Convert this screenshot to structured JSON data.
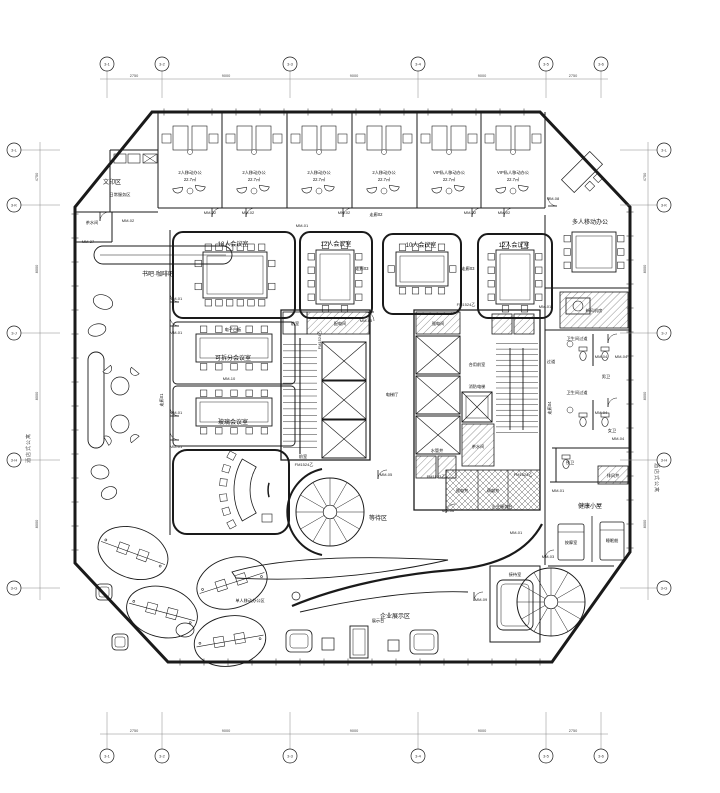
{
  "colors": {
    "line": "#1a1a1a",
    "grid": "#888888",
    "background": "#ffffff",
    "hatch": "#555555"
  },
  "plan": {
    "labels": [
      {
        "t": "文印区",
        "x": 112,
        "y": 184,
        "c": "r"
      },
      {
        "t": "日常服务区",
        "x": 120,
        "y": 196,
        "c": "s"
      },
      {
        "t": "茶水间",
        "x": 92,
        "y": 224,
        "c": "s"
      },
      {
        "t": "书吧·咖啡吧",
        "x": 158,
        "y": 276,
        "c": "r"
      },
      {
        "t": "2人移动办公",
        "x": 190,
        "y": 174,
        "c": "s"
      },
      {
        "t": "22.7㎡",
        "x": 190,
        "y": 181,
        "c": "s"
      },
      {
        "t": "2人移动办公",
        "x": 254,
        "y": 174,
        "c": "s"
      },
      {
        "t": "22.7㎡",
        "x": 254,
        "y": 181,
        "c": "s"
      },
      {
        "t": "2人移动办公",
        "x": 319,
        "y": 174,
        "c": "s"
      },
      {
        "t": "22.7㎡",
        "x": 319,
        "y": 181,
        "c": "s"
      },
      {
        "t": "2人移动办公",
        "x": 384,
        "y": 174,
        "c": "s"
      },
      {
        "t": "22.7㎡",
        "x": 384,
        "y": 181,
        "c": "s"
      },
      {
        "t": "VIP私人移动办公",
        "x": 449,
        "y": 174,
        "c": "s"
      },
      {
        "t": "22.7㎡",
        "x": 449,
        "y": 181,
        "c": "s"
      },
      {
        "t": "VIP私人移动办公",
        "x": 513,
        "y": 174,
        "c": "s"
      },
      {
        "t": "22.7㎡",
        "x": 513,
        "y": 181,
        "c": "s"
      },
      {
        "t": "多人移动办公",
        "x": 590,
        "y": 224,
        "c": "r"
      },
      {
        "t": "18人会议室",
        "x": 233,
        "y": 246,
        "c": "r"
      },
      {
        "t": "12人会议室",
        "x": 336,
        "y": 246,
        "c": "r"
      },
      {
        "t": "10人会议室",
        "x": 421,
        "y": 247,
        "c": "r"
      },
      {
        "t": "12人会议室",
        "x": 514,
        "y": 247,
        "c": "r"
      },
      {
        "t": "走廊02",
        "x": 376,
        "y": 216,
        "c": "s"
      },
      {
        "t": "走廊03",
        "x": 362,
        "y": 270,
        "c": "s"
      },
      {
        "t": "走廊03",
        "x": 468,
        "y": 270,
        "c": "s"
      },
      {
        "t": "电子白板",
        "x": 233,
        "y": 331,
        "c": "s"
      },
      {
        "t": "可拆分会议室",
        "x": 233,
        "y": 360,
        "c": "r"
      },
      {
        "t": "玻璃会议室",
        "x": 233,
        "y": 424,
        "c": "r"
      },
      {
        "t": "走廊01",
        "x": 163,
        "y": 400,
        "c": "s",
        "r": -90
      },
      {
        "t": "前室",
        "x": 295,
        "y": 325,
        "c": "s"
      },
      {
        "t": "配电间",
        "x": 340,
        "y": 325,
        "c": "s"
      },
      {
        "t": "强电间",
        "x": 438,
        "y": 325,
        "c": "s"
      },
      {
        "t": "电梯厅",
        "x": 392,
        "y": 396,
        "c": "s"
      },
      {
        "t": "合用前室",
        "x": 477,
        "y": 366,
        "c": "s"
      },
      {
        "t": "消防电梯",
        "x": 477,
        "y": 388,
        "c": "s"
      },
      {
        "t": "茶水间",
        "x": 478,
        "y": 448,
        "c": "s"
      },
      {
        "t": "水管井",
        "x": 437,
        "y": 452,
        "c": "s"
      },
      {
        "t": "强电井",
        "x": 462,
        "y": 492,
        "c": "s"
      },
      {
        "t": "弱电井",
        "x": 493,
        "y": 492,
        "c": "s"
      },
      {
        "t": "走廊04",
        "x": 551,
        "y": 408,
        "c": "s",
        "r": -90
      },
      {
        "t": "过道",
        "x": 551,
        "y": 363,
        "c": "s"
      },
      {
        "t": "新风机房",
        "x": 594,
        "y": 312,
        "c": "s"
      },
      {
        "t": "卫生间过道",
        "x": 577,
        "y": 340,
        "c": "s"
      },
      {
        "t": "男卫",
        "x": 606,
        "y": 378,
        "c": "s"
      },
      {
        "t": "卫生间过道",
        "x": 577,
        "y": 394,
        "c": "s"
      },
      {
        "t": "女卫",
        "x": 612,
        "y": 432,
        "c": "s"
      },
      {
        "t": "残卫",
        "x": 570,
        "y": 464,
        "c": "s"
      },
      {
        "t": "排风井",
        "x": 613,
        "y": 477,
        "c": "s"
      },
      {
        "t": "健康小屋",
        "x": 590,
        "y": 508,
        "c": "r"
      },
      {
        "t": "按摩室",
        "x": 571,
        "y": 544,
        "c": "s"
      },
      {
        "t": "睡眠舱",
        "x": 612,
        "y": 542,
        "c": "s"
      },
      {
        "t": "接待室",
        "x": 515,
        "y": 576,
        "c": "s"
      },
      {
        "t": "等待区",
        "x": 378,
        "y": 520,
        "c": "r"
      },
      {
        "t": "企业服务台",
        "x": 502,
        "y": 508,
        "c": "s"
      },
      {
        "t": "企业展示区",
        "x": 395,
        "y": 618,
        "c": "r"
      },
      {
        "t": "展示台",
        "x": 378,
        "y": 622,
        "c": "s"
      },
      {
        "t": "单人移动办公区",
        "x": 250,
        "y": 602,
        "c": "s"
      },
      {
        "t": "前室",
        "x": 303,
        "y": 458,
        "c": "s"
      },
      {
        "t": "酒店式公寓",
        "x": 30,
        "y": 448,
        "c": "sd",
        "r": -90
      },
      {
        "t": "酒店式公寓",
        "x": 655,
        "y": 478,
        "c": "sd",
        "r": 90
      },
      {
        "t": "MM-01",
        "x": 302,
        "y": 227,
        "c": "t"
      },
      {
        "t": "MM-01",
        "x": 176,
        "y": 300,
        "c": "t"
      },
      {
        "t": "MM-01",
        "x": 176,
        "y": 334,
        "c": "t"
      },
      {
        "t": "MM-01",
        "x": 176,
        "y": 414,
        "c": "t"
      },
      {
        "t": "MM-01",
        "x": 176,
        "y": 448,
        "c": "t"
      },
      {
        "t": "MM-01",
        "x": 545,
        "y": 308,
        "c": "t"
      },
      {
        "t": "MM-01",
        "x": 516,
        "y": 534,
        "c": "t"
      },
      {
        "t": "MM-01",
        "x": 558,
        "y": 492,
        "c": "t"
      },
      {
        "t": "MM-02",
        "x": 210,
        "y": 214,
        "c": "t"
      },
      {
        "t": "MM-02",
        "x": 248,
        "y": 214,
        "c": "t"
      },
      {
        "t": "MM-02",
        "x": 344,
        "y": 214,
        "c": "t"
      },
      {
        "t": "MM-02",
        "x": 470,
        "y": 214,
        "c": "t"
      },
      {
        "t": "MM-02",
        "x": 504,
        "y": 214,
        "c": "t"
      },
      {
        "t": "MM-02",
        "x": 128,
        "y": 222,
        "c": "t"
      },
      {
        "t": "MM-03",
        "x": 548,
        "y": 558,
        "c": "t"
      },
      {
        "t": "MM-04",
        "x": 601,
        "y": 358,
        "c": "t"
      },
      {
        "t": "MM-04",
        "x": 621,
        "y": 358,
        "c": "t"
      },
      {
        "t": "MM-04",
        "x": 601,
        "y": 414,
        "c": "t"
      },
      {
        "t": "MM-04",
        "x": 618,
        "y": 440,
        "c": "t"
      },
      {
        "t": "MM-05",
        "x": 366,
        "y": 322,
        "c": "t"
      },
      {
        "t": "MM-05",
        "x": 386,
        "y": 476,
        "c": "t"
      },
      {
        "t": "MM-06",
        "x": 448,
        "y": 512,
        "c": "t"
      },
      {
        "t": "MM-08",
        "x": 553,
        "y": 200,
        "c": "t"
      },
      {
        "t": "MM-09",
        "x": 481,
        "y": 601,
        "c": "t"
      },
      {
        "t": "MM-10",
        "x": 229,
        "y": 380,
        "c": "t"
      },
      {
        "t": "MM-27",
        "x": 88,
        "y": 243,
        "c": "t"
      },
      {
        "t": "FM1524乙",
        "x": 466,
        "y": 306,
        "c": "t"
      },
      {
        "t": "FM1524乙",
        "x": 304,
        "y": 466,
        "c": "t"
      },
      {
        "t": "FM1524乙",
        "x": 523,
        "y": 476,
        "c": "t"
      },
      {
        "t": "FM1524乙",
        "x": 321,
        "y": 340,
        "c": "t",
        "r": -90
      },
      {
        "t": "FM1523乙",
        "x": 436,
        "y": 478,
        "c": "t"
      }
    ],
    "grid": {
      "top": {
        "cy": 64,
        "lineY": 79,
        "x0": 100,
        "x1": 608,
        "bubbles": [
          [
            "3-1",
            107
          ],
          [
            "3-2",
            162
          ],
          [
            "3-3",
            290
          ],
          [
            "3-4",
            418
          ],
          [
            "3-5",
            546
          ],
          [
            "3-6",
            601
          ]
        ],
        "dims": [
          [
            "2750",
            134
          ],
          [
            "9000",
            226
          ],
          [
            "9000",
            354
          ],
          [
            "9000",
            482
          ],
          [
            "2750",
            573
          ]
        ]
      },
      "bottom": {
        "cy": 756,
        "lineY": 734,
        "x0": 100,
        "x1": 608,
        "bubbles": [
          [
            "3-1",
            107
          ],
          [
            "3-2",
            162
          ],
          [
            "3-3",
            290
          ],
          [
            "3-4",
            418
          ],
          [
            "3-5",
            546
          ],
          [
            "3-6",
            601
          ]
        ],
        "dims": [
          [
            "2750",
            134
          ],
          [
            "9000",
            226
          ],
          [
            "9000",
            354
          ],
          [
            "9000",
            482
          ],
          [
            "2750",
            573
          ]
        ]
      },
      "left": {
        "cx": 14,
        "lineX": 40,
        "y0": 142,
        "y1": 600,
        "bubbles": [
          [
            "3-L",
            150
          ],
          [
            "3-K",
            205
          ],
          [
            "3-J",
            333
          ],
          [
            "3-H",
            460
          ],
          [
            "3-G",
            588
          ]
        ],
        "dims": [
          [
            "4750",
            177
          ],
          [
            "8000",
            269
          ],
          [
            "8000",
            396
          ],
          [
            "8000",
            524
          ]
        ]
      },
      "right": {
        "cx": 664,
        "lineX": 648,
        "y0": 142,
        "y1": 600,
        "bubbles": [
          [
            "3-L",
            150
          ],
          [
            "3-K",
            205
          ],
          [
            "3-J",
            333
          ],
          [
            "3-H",
            460
          ],
          [
            "3-G",
            588
          ]
        ],
        "dims": [
          [
            "4750",
            177
          ],
          [
            "8000",
            269
          ],
          [
            "8000",
            396
          ],
          [
            "8000",
            524
          ]
        ]
      }
    }
  }
}
